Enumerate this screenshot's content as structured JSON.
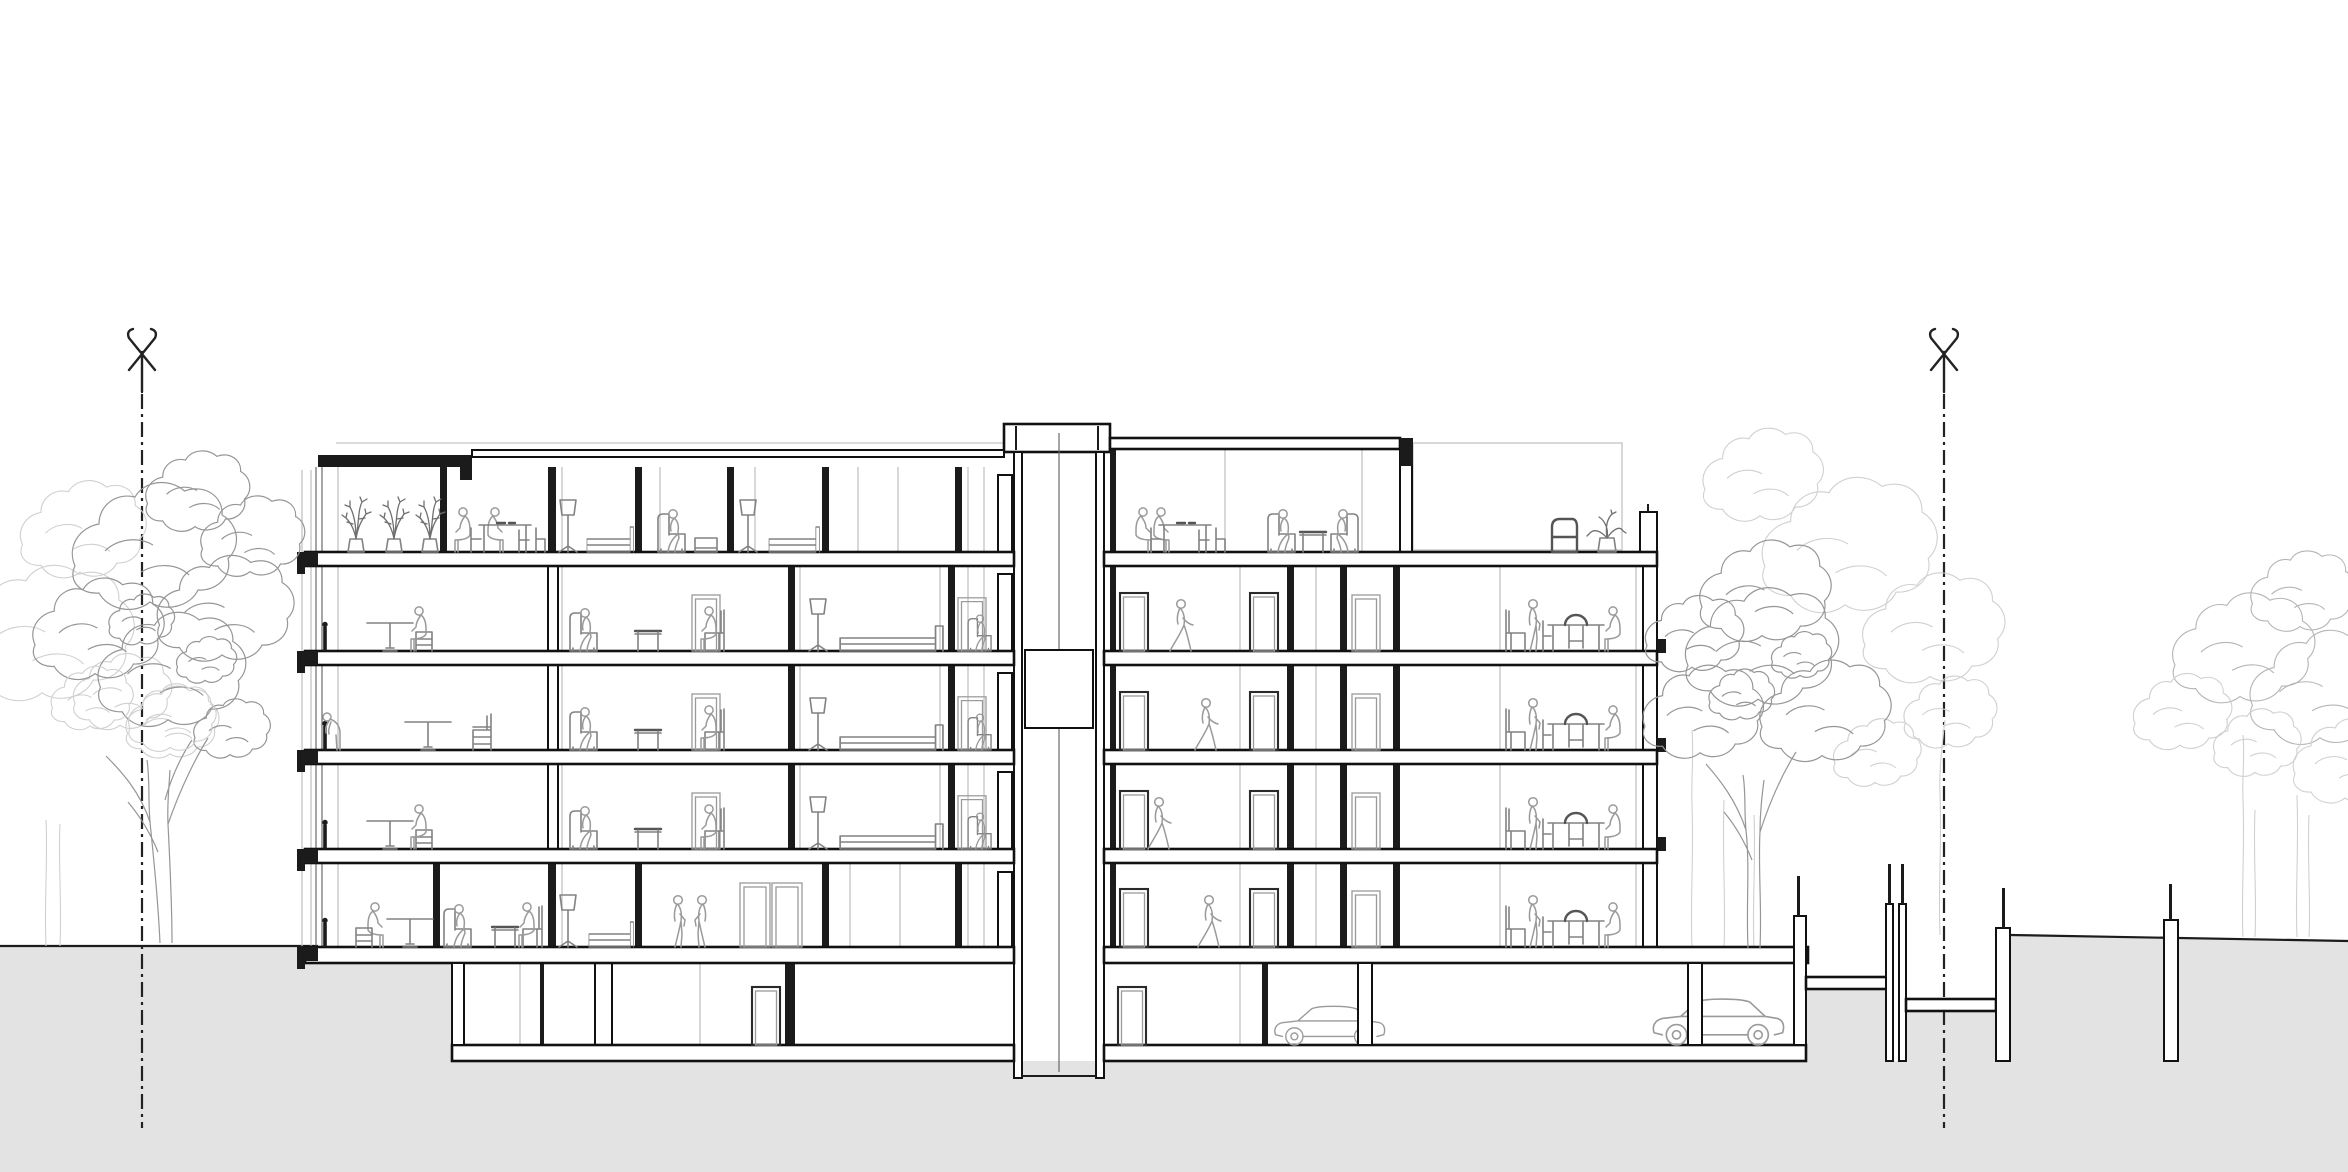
{
  "drawing": {
    "title": "Architectural cross-section: five-storey residential building with roof loggia, central elevator core, ground-level terrace and basement parking garage",
    "view": "section",
    "orientation": "landscape"
  },
  "colors": {
    "paper": "#ffffff",
    "structure": "#1b1b1b",
    "slab_line": "#111111",
    "ground_fill": "#e3e3e3",
    "ground_line": "#1c1c1c",
    "axis": "#222222",
    "people": "#9a9a9a",
    "furniture": "#828282",
    "furniture_dark": "#555555",
    "door": "#2a2a2a",
    "door_leaf": "#9a9a9a",
    "plant": "#6f6f6f",
    "tree_front": "#969696",
    "tree_mid": "#b5b5b5",
    "tree_back": "#d0d0d0",
    "background_line": "#c4c4c4",
    "glazing": "#6a6a6a",
    "car": "#9a9a9a"
  },
  "axes": {
    "left": {
      "symbol": "survey-cross-marker",
      "line_style": "dash-dot"
    },
    "right": {
      "symbol": "survey-cross-marker",
      "line_style": "dash-dot"
    }
  },
  "floors": [
    {
      "id": "level-5",
      "label": "Attic level",
      "scenes": [
        "loggia with three potted plants",
        "couple seated at dining table",
        "bedroom with floor lamp and bed",
        "person in armchair with ottoman",
        "bedroom with floor lamp and bed",
        "common room: two people at table, two people in facing armchairs",
        "roof terrace with chair and potted plant"
      ]
    },
    {
      "id": "level-4",
      "label": "Upper floor",
      "scenes": [
        "person seated at pedestal table",
        "two people seated in armchairs with side table",
        "bedroom with floor lamp and bed",
        "person in armchair",
        "corridor with walking person",
        "dining room: standing and seated person at table"
      ]
    },
    {
      "id": "level-3",
      "label": "Upper floor",
      "scenes": [
        "person leaning at balcony window",
        "pedestal table and chair",
        "two people seated in armchairs with side table",
        "bedroom with floor lamp and bed",
        "person in armchair",
        "corridor with walking person",
        "dining room: standing and seated person at table"
      ]
    },
    {
      "id": "level-2",
      "label": "Upper floor",
      "scenes": [
        "person seated at pedestal table",
        "two people seated in armchairs with side table",
        "bedroom with floor lamp and bed",
        "person in armchair",
        "corridor with walking person",
        "dining room: standing and seated person at table"
      ]
    },
    {
      "id": "level-1",
      "label": "Ground floor",
      "scenes": [
        "person seated at pedestal table",
        "two people in armchairs",
        "bedroom with floor lamp and bed",
        "two people standing near double door",
        "corridor with walking person",
        "dining room: standing and seated person at table"
      ]
    },
    {
      "id": "basement",
      "label": "Basement",
      "scenes": [
        "storage rooms with doors",
        "parking garage with two cars and columns"
      ]
    }
  ],
  "core": {
    "element": "elevator-shaft",
    "car_visible": true,
    "tower_above_roof": true
  },
  "site": {
    "people_total": 36,
    "cars_in_garage": 2,
    "tree_groups": [
      {
        "position": "left",
        "trees": 2
      },
      {
        "position": "right-of-building",
        "trees": 3
      },
      {
        "position": "far-right",
        "trees": 2
      }
    ],
    "retaining_walls": 4,
    "light_well_bridges": 2,
    "ground": "grey sectional poché with sloping grade on the right"
  }
}
